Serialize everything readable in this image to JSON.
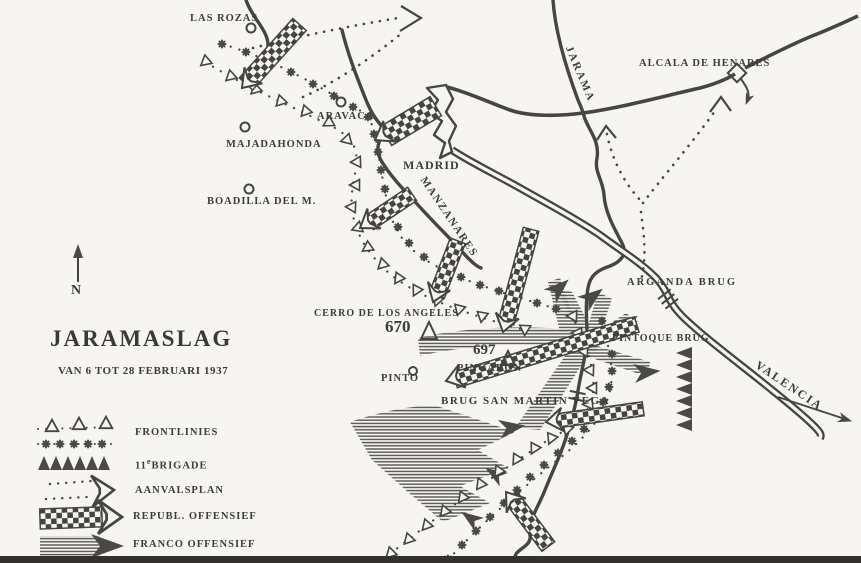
{
  "map": {
    "title": "JARAMASLAG",
    "subtitle": "VAN 6 TOT 28 FEBRUARI 1937",
    "compass": "N",
    "ink_color": "#46453f",
    "paper_color": "#f6f5f1",
    "places": {
      "las_rozas": "LAS ROZAS",
      "aravaca": "ARAVACA",
      "majadahonda": "MAJADAHONDA",
      "boadilla": "BOADILLA DEL M.",
      "madrid": "MADRID",
      "alcala": "ALCALA DE HENARES",
      "pinto": "PINTO"
    },
    "rivers": {
      "jarama": "JARAMA",
      "manzanares": "MANZANARES"
    },
    "bridges": {
      "arganda": "ARGANDA BRUG",
      "pintoque": "PINTOQUE BRUG",
      "san_martin": "BRUG SAN MARTIN VEGA"
    },
    "hills": {
      "cerro_name": "CERRO DE LOS ANGELES",
      "cerro_elevation": "670",
      "pingaron_name": "PINGARON",
      "pingaron_elevation": "697"
    },
    "route": {
      "valencia": "VALENCIA"
    }
  },
  "legend": {
    "items": [
      {
        "symbol": "frontline",
        "label": "FRONTLINIES"
      },
      {
        "symbol": "11th-brigade",
        "label_pre": "11",
        "label_sup": "e",
        "label_main": "BRIGADE"
      },
      {
        "symbol": "attack-plan",
        "label": "AANVALSPLAN"
      },
      {
        "symbol": "republican-offensive",
        "label": "REPUBL. OFFENSIEF"
      },
      {
        "symbol": "franco-offensive",
        "label": "FRANCO OFFENSIEF"
      }
    ]
  }
}
